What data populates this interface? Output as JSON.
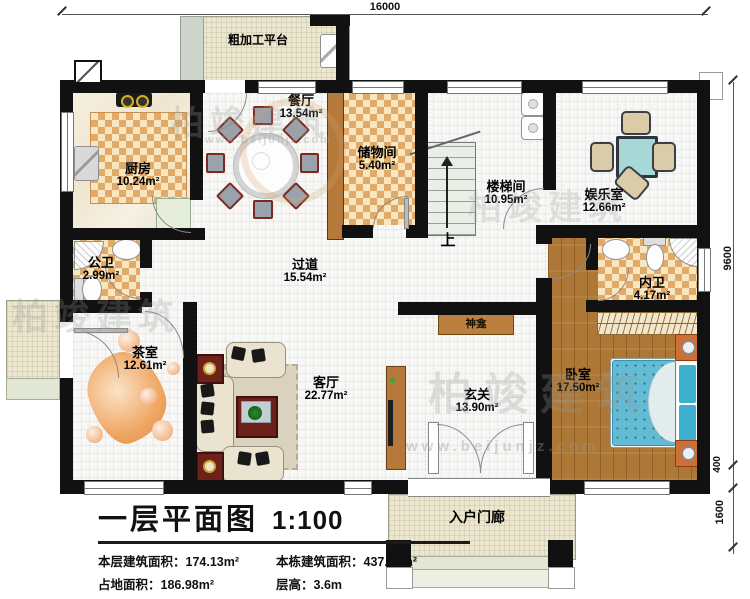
{
  "dimensions": {
    "top_width": "16000",
    "right_height": "9600",
    "right_step": "400",
    "right_porch": "1600"
  },
  "rooms": {
    "rough_platform": {
      "name": "粗加工平台"
    },
    "kitchen": {
      "name": "厨房",
      "area": "10.24m²"
    },
    "dining": {
      "name": "餐厅",
      "area": "13.54m²"
    },
    "storage": {
      "name": "储物间",
      "area": "5.40m²"
    },
    "stairwell": {
      "name": "楼梯间",
      "area": "10.95m²"
    },
    "entertainment": {
      "name": "娱乐室",
      "area": "12.66m²"
    },
    "public_bath": {
      "name": "公卫",
      "area": "2.99m²"
    },
    "corridor": {
      "name": "过道",
      "area": "15.54m²"
    },
    "ensuite_bath": {
      "name": "内卫",
      "area": "4.17m²"
    },
    "tea_room": {
      "name": "茶室",
      "area": "12.61m²"
    },
    "living_room": {
      "name": "客厅",
      "area": "22.77m²"
    },
    "entry": {
      "name": "玄关",
      "area": "13.90m²"
    },
    "bedroom": {
      "name": "卧室",
      "area": "17.50m²"
    },
    "shrine": {
      "name": "神龛"
    },
    "porch": {
      "name": "入户门廊"
    }
  },
  "annotations": {
    "stairs_up": "上"
  },
  "watermark": {
    "brand": "柏竣建筑",
    "url": "www.beijunjz.com"
  },
  "title_block": {
    "title": "一层平面图",
    "scale": "1:100",
    "stats": [
      {
        "label": "本层建筑面积：",
        "value": "174.13m²"
      },
      {
        "label": "本栋建筑面积：",
        "value": "437.00m²"
      },
      {
        "label": "占地面积：",
        "value": "186.98m²"
      },
      {
        "label": "层高：",
        "value": "3.6m"
      }
    ]
  },
  "colors": {
    "wall": "#111111",
    "checker_tile": "#e2aa68",
    "wood_floor": "#ad7836",
    "bed": "#64bcd4",
    "game_table": "#a7d7d6",
    "living_tables": "#6e211a"
  }
}
